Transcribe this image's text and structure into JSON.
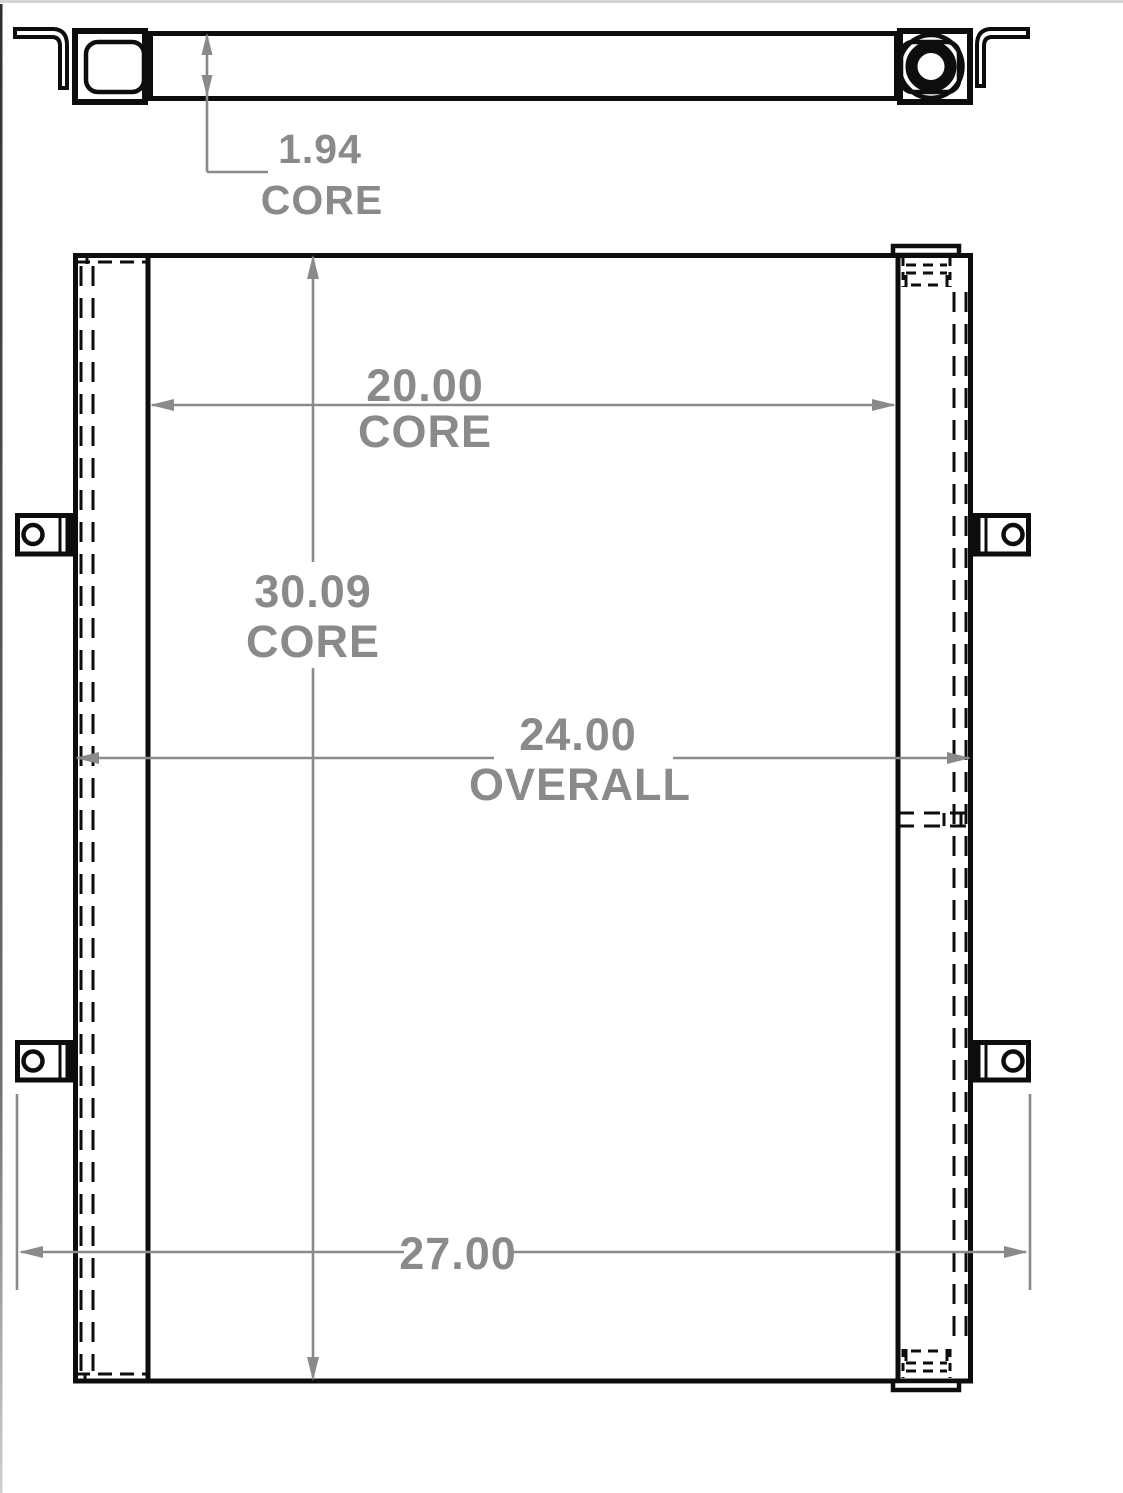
{
  "drawing_title": "Oil Cooler Dimension Drawing",
  "dimensions": {
    "core_depth": {
      "value": "1.94",
      "label": "CORE"
    },
    "core_width": {
      "value": "20.00",
      "label": "CORE"
    },
    "core_height": {
      "value": "30.09",
      "label": "CORE"
    },
    "overall_width": {
      "value": "24.00",
      "label": "OVERALL"
    },
    "bracket_width": {
      "value": "27.00"
    }
  },
  "colors": {
    "line_black": "#0d0d0d",
    "dimension_gray": "#8a8a8a",
    "background": "#ffffff",
    "top_border": "#d4d4d4"
  }
}
